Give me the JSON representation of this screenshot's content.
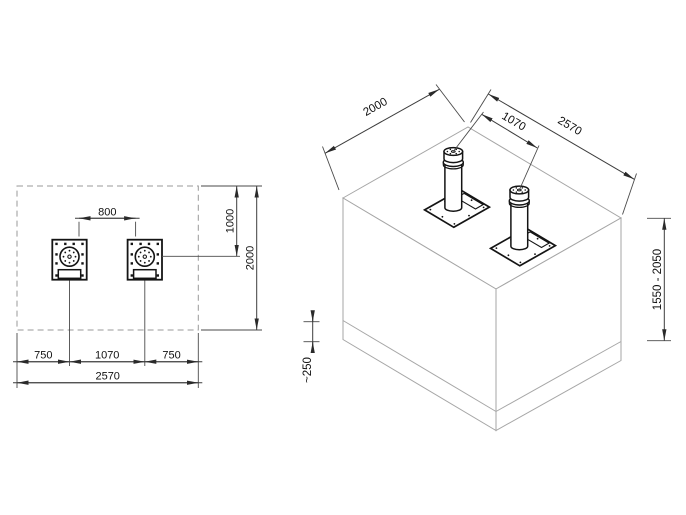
{
  "plan": {
    "dims": {
      "d800": "800",
      "d1000": "1000",
      "d2000": "2000",
      "d750_left": "750",
      "d1070": "1070",
      "d750_right": "750",
      "d2570": "2570"
    }
  },
  "iso": {
    "dims": {
      "d2000": "2000",
      "d1070": "1070",
      "d2570": "2570",
      "d_height_range": "1550 - 2050",
      "d_base_depth": "~250"
    }
  },
  "colors": {
    "background": "#ffffff",
    "outline_dark": "#141414",
    "block_outline": "#a6a6a6",
    "dimension_line": "#3c3c3c",
    "text": "#101010"
  }
}
